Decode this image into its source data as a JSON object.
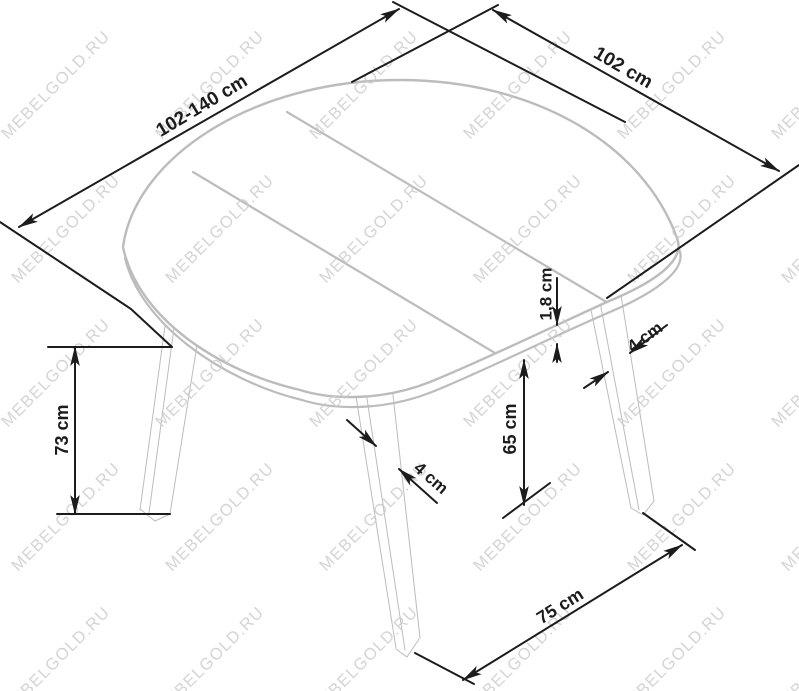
{
  "page": {
    "background": "#ffffff",
    "width": 799,
    "height": 691
  },
  "watermark": {
    "text": "MEBELGOLD.RU",
    "color": "#c9c9c9",
    "opacity": 0.8,
    "font_size": 16.5,
    "letter_spacing": 1.2,
    "rotation": -45,
    "grid": {
      "x_start": 8,
      "x_step": 154,
      "cols": 6,
      "y_start": 140,
      "y_step": 144,
      "rows": 5,
      "row_x_offset": 10
    }
  },
  "diagram": {
    "kind": "furniture-dimension-drawing",
    "colors": {
      "dimension": "#1c1c1c",
      "furniture": "#bcbcbc"
    },
    "dimension_labels": [
      {
        "id": "length-range",
        "text": "102-140 cm",
        "x": 202,
        "y": 106,
        "rotation": -31,
        "font_size": 19
      },
      {
        "id": "width",
        "text": "102 cm",
        "x": 623,
        "y": 68,
        "rotation": 30,
        "font_size": 19
      },
      {
        "id": "height",
        "text": "73 cm",
        "x": 62,
        "y": 430,
        "rotation": -90,
        "font_size": 18
      },
      {
        "id": "clearance",
        "text": "65 cm",
        "x": 510,
        "y": 429,
        "rotation": -90,
        "font_size": 18
      },
      {
        "id": "top-thickness",
        "text": "1,8 cm",
        "x": 546,
        "y": 294,
        "rotation": -90,
        "font_size": 17
      },
      {
        "id": "front-leg",
        "text": "4 cm",
        "x": 431,
        "y": 478,
        "rotation": 41,
        "font_size": 17
      },
      {
        "id": "rear-leg",
        "text": "4 cm",
        "x": 645,
        "y": 337,
        "rotation": -36,
        "font_size": 17
      },
      {
        "id": "leg-span",
        "text": "75 cm",
        "x": 560,
        "y": 606,
        "rotation": -32,
        "font_size": 18
      }
    ]
  }
}
